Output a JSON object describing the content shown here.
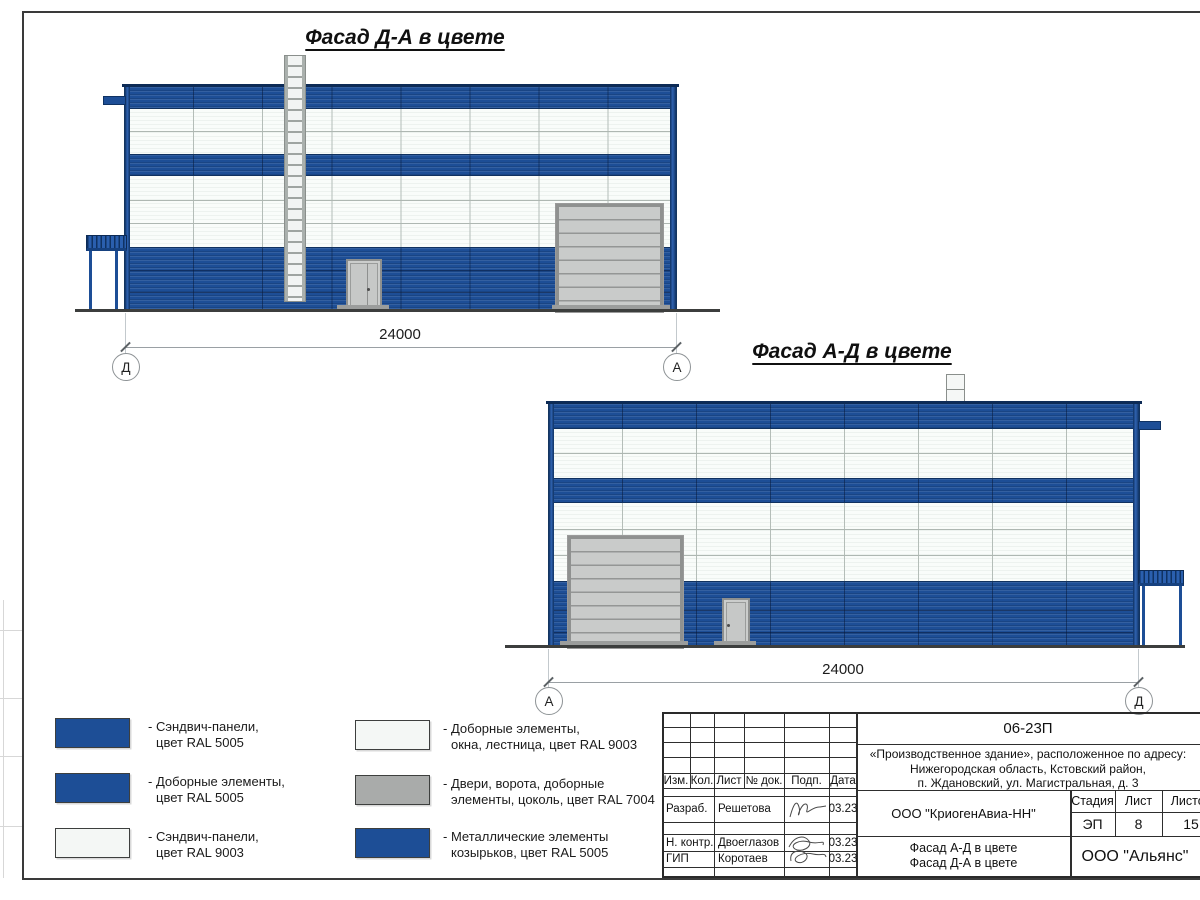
{
  "sheet": {
    "facade1": {
      "title": "Фасад Д-А в цвете",
      "dim": "24000",
      "axis_left": "Д",
      "axis_right": "А"
    },
    "facade2": {
      "title": "Фасад А-Д в цвете",
      "dim": "24000",
      "axis_left": "А",
      "axis_right": "Д"
    }
  },
  "palette": {
    "blue": "#1d4e96",
    "blue_dark": "#123a73",
    "white_panel": "#f4f7f5",
    "gray_7004": "#a9abaa",
    "gate_gray": "#c7c9c8",
    "ground": "#3c3e3d"
  },
  "legend": {
    "items": [
      {
        "color": "#1d4e96",
        "line1": "- Сэндвич-панели,",
        "line2": "цвет RAL 5005"
      },
      {
        "color": "#1d4e96",
        "line1": "- Доборные элементы,",
        "line2": "цвет RAL 5005"
      },
      {
        "color": "#f4f7f5",
        "line1": "- Сэндвич-панели,",
        "line2": "цвет RAL 9003"
      },
      {
        "color": "#f4f7f5",
        "line1": "- Доборные элементы,",
        "line2": "окна, лестница, цвет RAL 9003"
      },
      {
        "color": "#a9abaa",
        "line1": "- Двери, ворота, доборные",
        "line2": "элементы, цоколь, цвет RAL 7004"
      },
      {
        "color": "#1d4e96",
        "line1": "- Металлические элементы",
        "line2": "козырьков, цвет RAL 5005"
      }
    ]
  },
  "title_block": {
    "doc_number": "06-23П",
    "project_line1": "«Производственное здание», расположенное по адресу:",
    "project_line2": "Нижегородская область, Кстовский район,",
    "project_line3": "п. Ждановский, ул. Магистральная, д. 3",
    "col_izm": "Изм.",
    "col_kol": "Кол.",
    "col_list": "Лист",
    "col_doc": "№ док.",
    "col_sign": "Подп.",
    "col_date": "Дата",
    "sign_rows": [
      {
        "role": "Разраб.",
        "name": "Решетова",
        "date": "03.23"
      },
      {
        "role": "Н. контр.",
        "name": "Двоеглазов",
        "date": "03.23"
      },
      {
        "role": "ГИП",
        "name": "Коротаев",
        "date": "03.23"
      }
    ],
    "org": "ООО \"КриогенАвиа-НН\"",
    "stage_label": "Стадия",
    "list_label": "Лист",
    "listov_label": "Листов",
    "stage": "ЭП",
    "list": "8",
    "listov": "15",
    "drawing_title1": "Фасад А-Д в цвете",
    "drawing_title2": "Фасад Д-А в цвете",
    "company": "ООО \"Альянс\""
  }
}
